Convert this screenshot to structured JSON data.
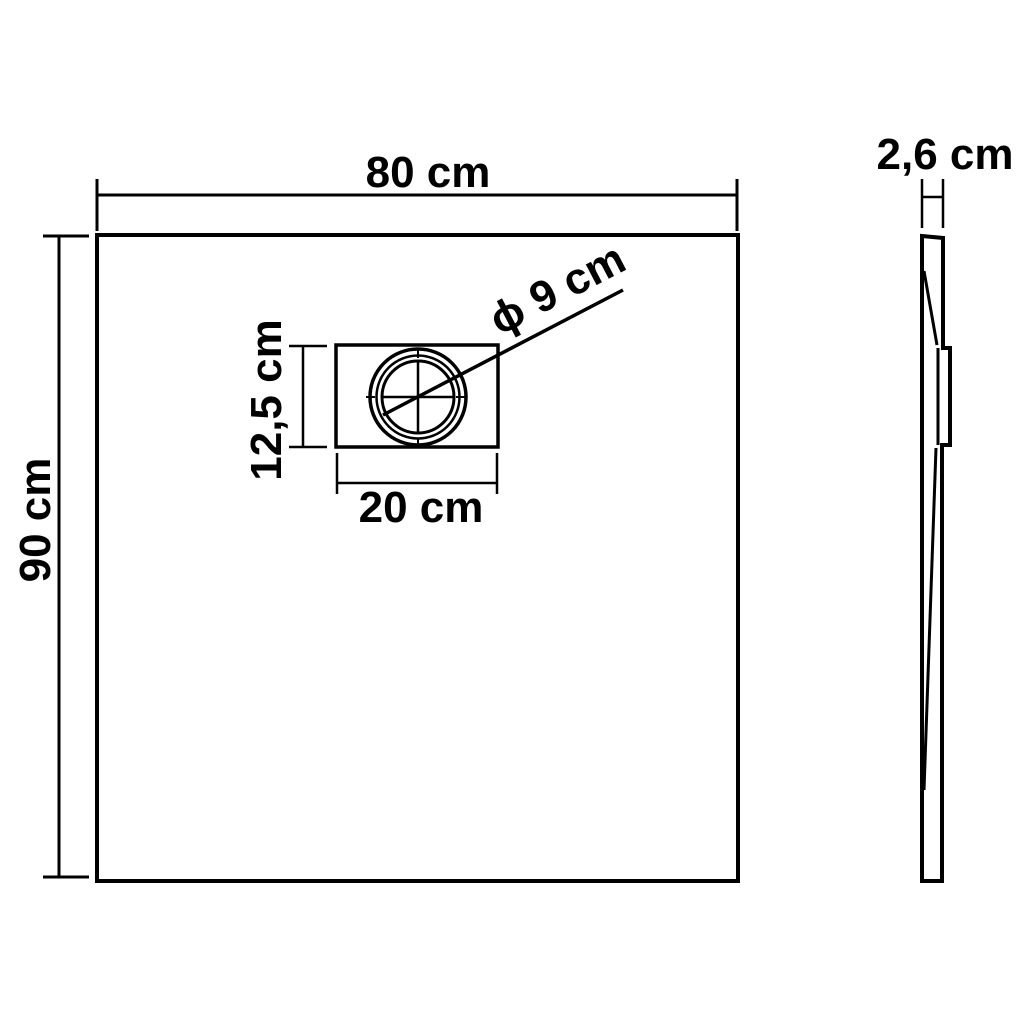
{
  "diagram_title": "shower-tray-dimension-drawing",
  "colors": {
    "line": "#000000",
    "background": "#ffffff"
  },
  "views": {
    "front_view": {
      "width_label": "80 cm",
      "height_label": "90 cm",
      "drain": {
        "width_label": "20 cm",
        "height_label": "12,5 cm",
        "diameter_label": "ϕ 9 cm"
      }
    },
    "side_view": {
      "thickness_label": "2,6 cm"
    }
  }
}
